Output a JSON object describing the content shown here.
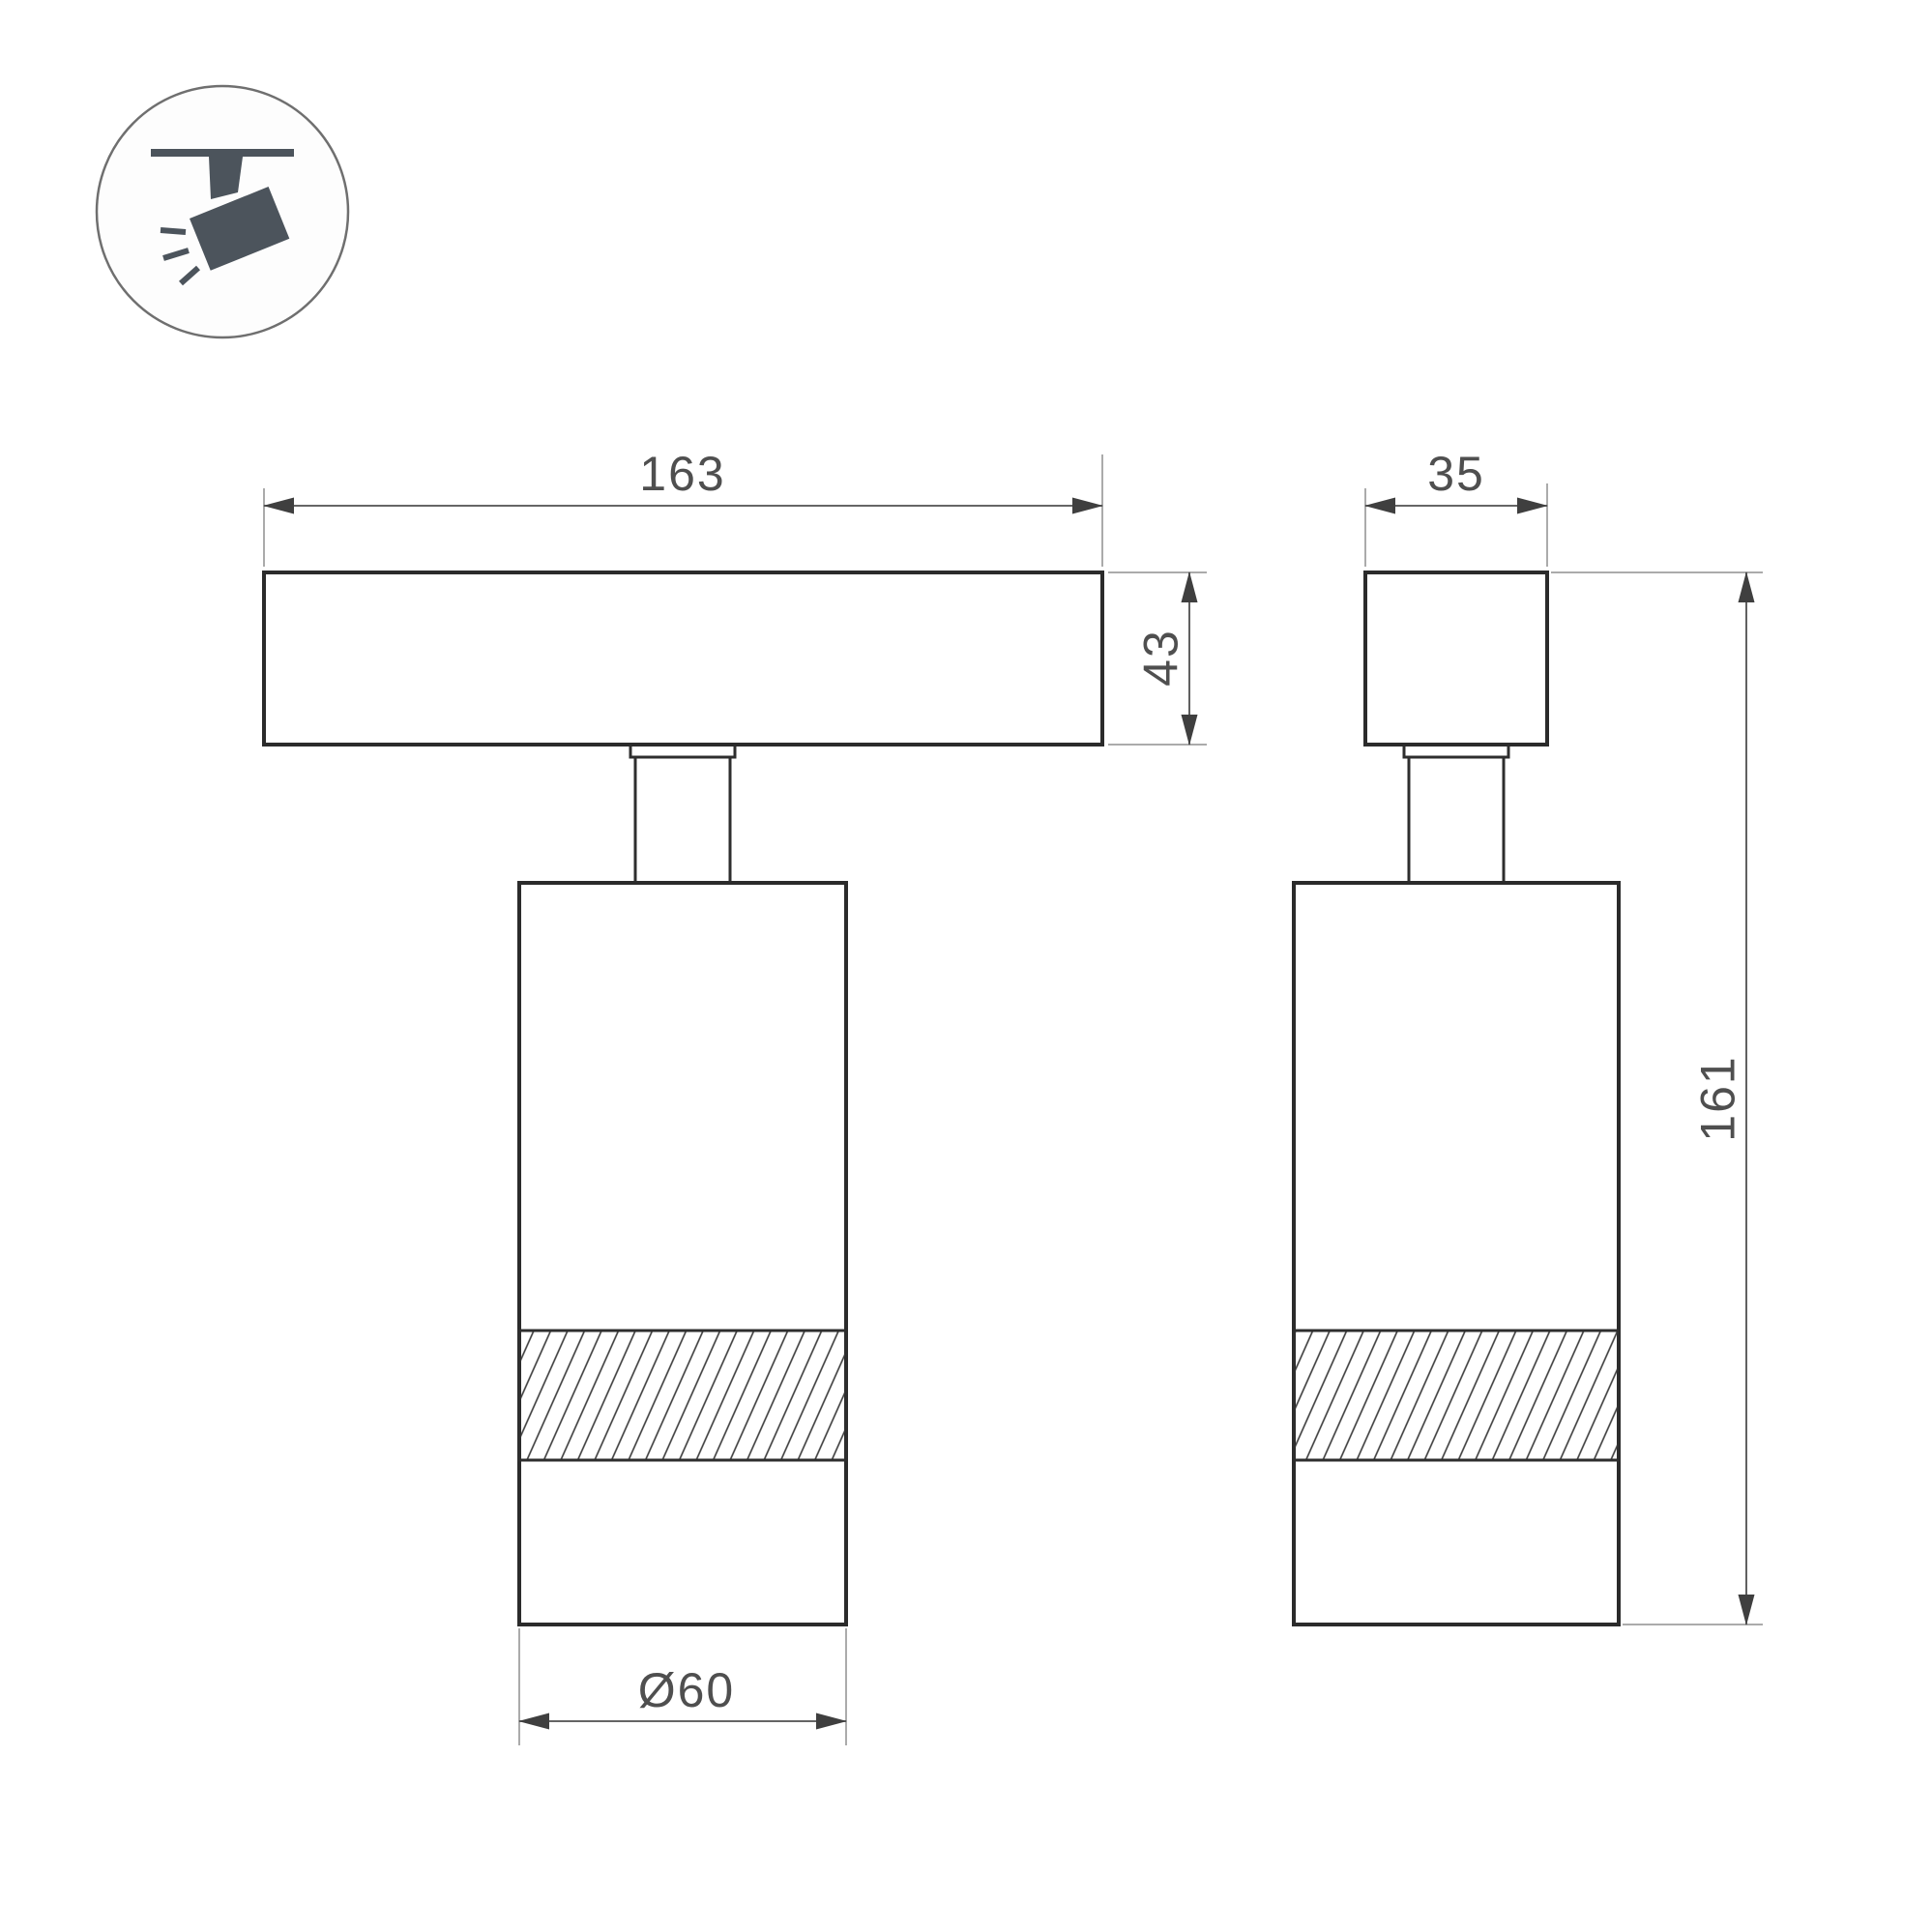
{
  "drawing": {
    "kind": "technical-dimension-drawing",
    "background": "#ffffff"
  },
  "icon": {
    "name": "ceiling-track-spotlight",
    "color": "#4c545c",
    "circle_border": "#6f6f6f"
  },
  "views": {
    "front": {
      "track_width": "163",
      "track_height": "43",
      "body_diameter": "Ø60"
    },
    "side": {
      "track_depth": "35",
      "total_height": "161"
    }
  },
  "colors": {
    "object_line": "#2b2b2b",
    "dimension_line": "#4f4f4f",
    "extension_line": "#8f8f8f",
    "dimension_text": "#4f4f4f",
    "hatch_line": "#3a3a3a"
  }
}
